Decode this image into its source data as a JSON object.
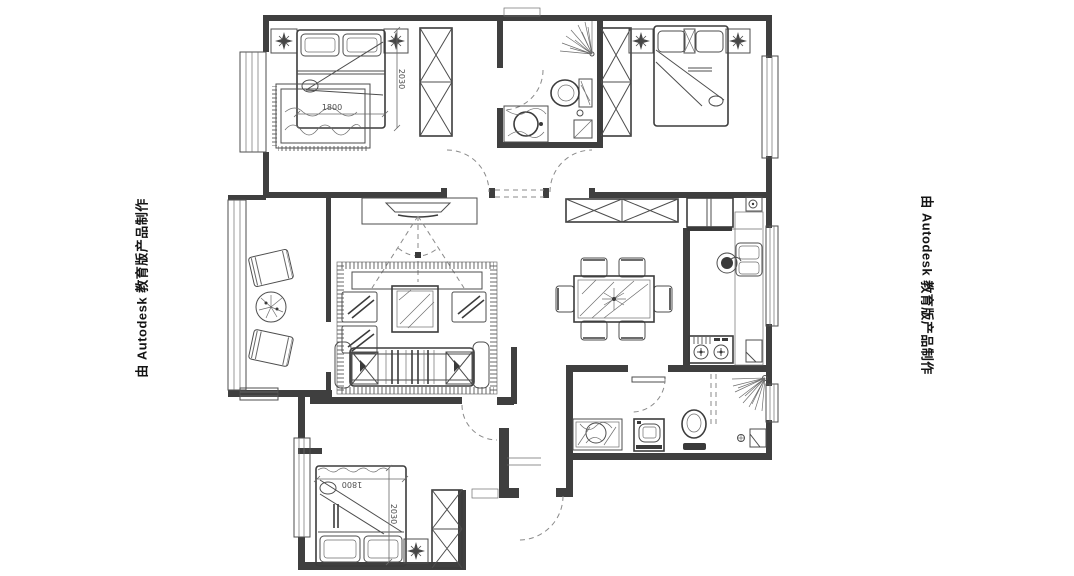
{
  "watermark": {
    "left": "由 Autodesk 教育版产品制作",
    "right": "由 Autodesk 教育版产品制作"
  },
  "dimensions": {
    "master_bedroom": {
      "width": "1800",
      "depth": "2030"
    },
    "second_bedroom": {
      "width": "1800",
      "depth": "2030"
    }
  },
  "colors": {
    "wall": "#3f3f3f",
    "line": "#4d4d4d",
    "dashed": "#8a8a8a",
    "dimension_text": "#4d4d4d",
    "watermark_text": "#141414",
    "background": "#ffffff"
  },
  "icons": [
    "double-bed-icon",
    "pillow-icon",
    "wardrobe-icon",
    "nightstand-star-icon",
    "rug-icon",
    "toilet-icon",
    "shower-spray-icon",
    "wash-basin-icon",
    "floor-drain-icon",
    "tv-icon",
    "sofa-icon",
    "coffee-table-icon",
    "dining-table-icon",
    "dining-chair-icon",
    "sideboard-icon",
    "refrigerator-icon",
    "kitchen-sink-icon",
    "gas-stove-icon",
    "washing-machine-icon",
    "lounge-chair-icon",
    "plant-icon",
    "door-swing-icon",
    "window-icon"
  ]
}
